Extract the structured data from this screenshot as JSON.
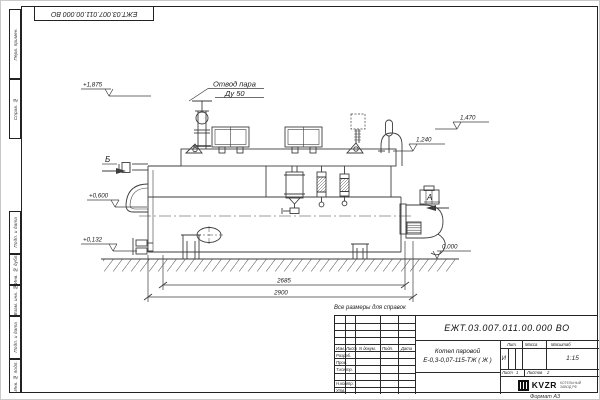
{
  "corner_stamp": {
    "doc_number": "ЕЖТ.03.007.011.00.000 ВО"
  },
  "margin_stamps": [
    "Перв. примен.",
    "Справ. №",
    "Подп. и дата",
    "Инв. № дубл.",
    "Взам. инв. №",
    "Подп. и дата",
    "Инв. № подл."
  ],
  "drawing": {
    "note": "Все размеры для справок",
    "callouts": {
      "steam_outlet_line1": "Отвод пара",
      "steam_outlet_line2": "Ду 50"
    },
    "views": {
      "b": "Б",
      "a": "А"
    },
    "elevations": {
      "valve_top": "+1,875",
      "boxes_top": "1,470",
      "drum_top": "1,240",
      "door_axis": "+0,600",
      "drain_axis": "+0,132",
      "ground": "0,000"
    },
    "dimensions": {
      "body_length": "2685",
      "overall_length": "2900"
    }
  },
  "title_block": {
    "doc_number": "ЕЖТ.03.007.011.00.000  ВО",
    "product_name_line1": "Котел паровой",
    "product_name_line2": "Е-0,3-0,07-115-ТЖ ( Ж )",
    "columns": {
      "izm": "Изм.",
      "list": "Лист",
      "doc": "N докум.",
      "sign": "Подп.",
      "date": "Дата"
    },
    "rows": {
      "developed": "Разраб.",
      "checked": "Пров.",
      "tcontrol": "Т.контр.",
      "ncontrol": "Н.контр.",
      "approved": "Утв."
    },
    "lit_header": "Лит.",
    "mass_header": "Масса",
    "scale_header": "Масштаб",
    "lit_value": "И",
    "scale_value": "1:15",
    "sheet_label": "Лист",
    "sheet_value": "1",
    "sheets_label": "Листов",
    "sheets_value": "2",
    "company_logo": "KVZR",
    "company_line1": "КОТЕЛЬНЫЙ",
    "company_line2": "ЗАВОД РФ",
    "format_label": "Формат А3"
  }
}
